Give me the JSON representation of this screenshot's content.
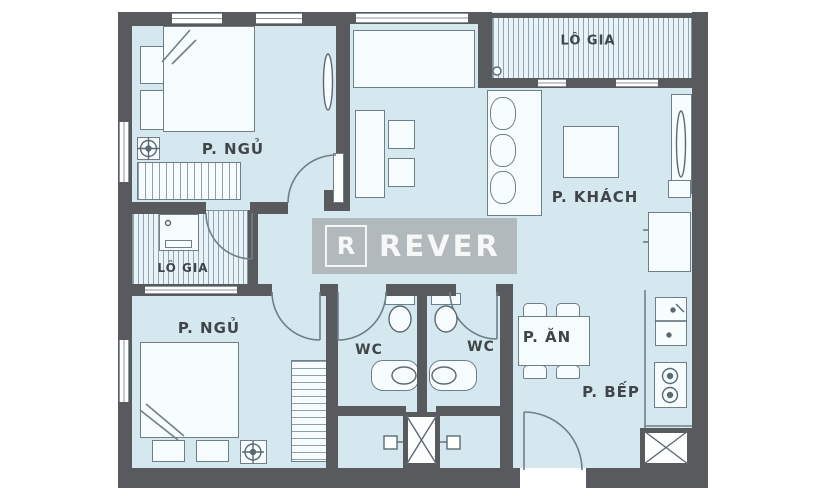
{
  "watermark": {
    "letter": "R",
    "brand": "REVER"
  },
  "rooms": {
    "bedroom_top": {
      "label": "P. NGỦ"
    },
    "balcony_top": {
      "label": "LÔ GIA"
    },
    "living": {
      "label": "P. KHÁCH"
    },
    "balcony_left": {
      "label": "LÔ GIA"
    },
    "bedroom_bottom": {
      "label": "P. NGỦ"
    },
    "wc_left": {
      "label": "WC"
    },
    "wc_right": {
      "label": "WC"
    },
    "dining": {
      "label": "P. ĂN"
    },
    "kitchen": {
      "label": "P. BẾP"
    }
  },
  "colors": {
    "wall": "#595a5d",
    "room_fill": "#d6e8ef",
    "balcony_stripe": "#8fa6b0",
    "furniture_line": "#6e7f89",
    "label_text": "#3f4549",
    "watermark_bg": "#b2b8bb",
    "watermark_text": "#ffffff"
  }
}
